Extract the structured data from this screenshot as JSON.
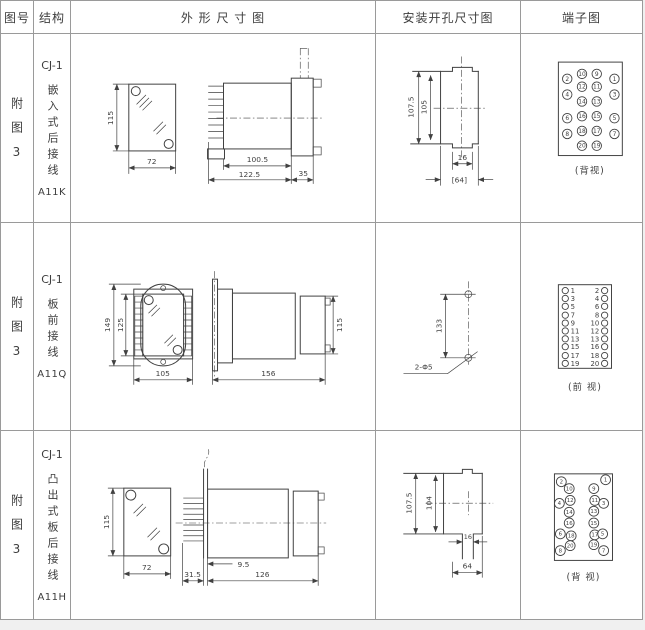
{
  "theme": {
    "bg": "#f0f0f0",
    "paper": "#ffffff",
    "grid": "#9a9a9a",
    "line": "#414141",
    "text": "#3d3d3d"
  },
  "header": {
    "figure": "图号",
    "structure": "结构",
    "outline": "外 形 尺 寸 图",
    "mounting": "安装开孔尺寸图",
    "terminal": "端子图"
  },
  "rows": [
    {
      "figure": "附图3",
      "model": "CJ-1",
      "desc": "嵌入式后接线",
      "code": "A11K",
      "outline": {
        "height": "115",
        "width": "72",
        "depth": "100.5",
        "total_depth": "122.5",
        "flange": "35"
      },
      "mounting": {
        "outer_height": "107.5",
        "inner_height": "105",
        "slot_width": "16",
        "panel_width": "[64]"
      },
      "terminal": {
        "view": "(背视)",
        "outer_left": [
          "2",
          "4",
          "6",
          "8"
        ],
        "inner_left": [
          "10",
          "12",
          "14",
          "16",
          "18",
          "20"
        ],
        "inner_right": [
          "9",
          "11",
          "13",
          "15",
          "17",
          "19"
        ],
        "outer_right": [
          "1",
          "3",
          "5",
          "7"
        ]
      }
    },
    {
      "figure": "附图3",
      "model": "CJ-1",
      "desc": "板前接线",
      "code": "A11Q",
      "outline": {
        "height": "149",
        "inner_height": "125",
        "width": "105",
        "depth": "156",
        "body_height": "115"
      },
      "mounting": {
        "hole_spacing": "133",
        "holes_label": "2-Φ5"
      },
      "terminal": {
        "view": "(前 视)",
        "left": [
          "1",
          "3",
          "5",
          "7",
          "9",
          "11",
          "13",
          "15",
          "17",
          "19"
        ],
        "right": [
          "2",
          "4",
          "6",
          "8",
          "10",
          "12",
          "13",
          "16",
          "18",
          "20"
        ]
      }
    },
    {
      "figure": "附图3",
      "model": "CJ-1",
      "desc": "凸出式板后接线",
      "code": "A11H",
      "outline": {
        "height": "115",
        "width": "72",
        "pin_depth": "31.5",
        "offset": "9.5",
        "depth": "126"
      },
      "mounting": {
        "outer_height": "107.5",
        "inner_height": "104",
        "slot_width": "16",
        "panel_width": "64"
      },
      "terminal": {
        "view": "(背 视)",
        "outer_left": [
          "2",
          "4",
          "6",
          "8"
        ],
        "inner_left": [
          "10",
          "12",
          "14",
          "16",
          "18",
          "20"
        ],
        "inner_right": [
          "9",
          "11",
          "13",
          "15",
          "17",
          "19"
        ],
        "outer_right": [
          "1",
          "3",
          "5",
          "7"
        ]
      }
    }
  ]
}
